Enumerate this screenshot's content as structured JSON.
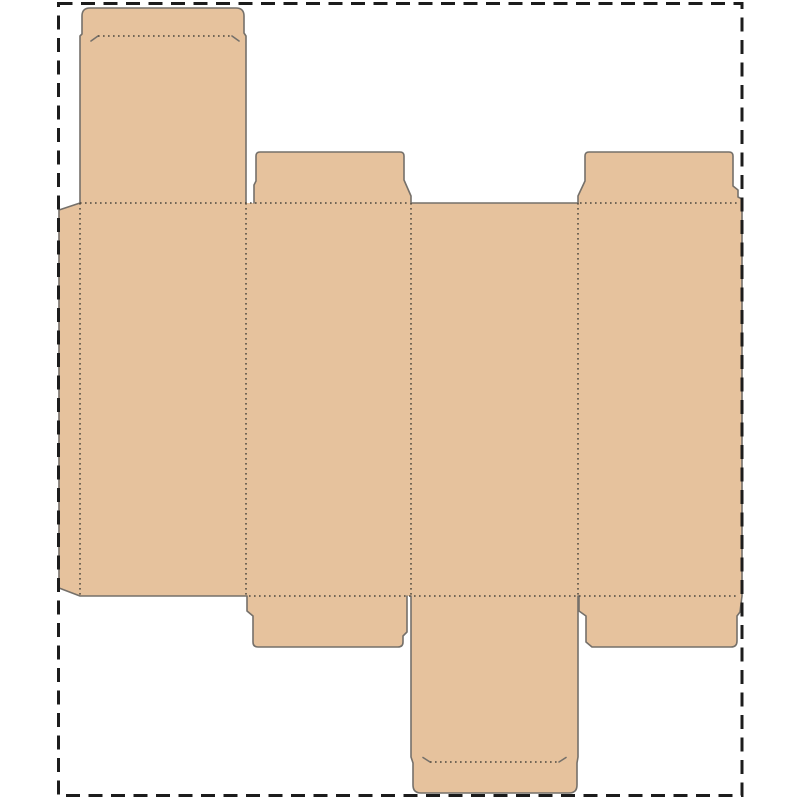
{
  "page": {
    "background_color": "#ffffff",
    "width_px": 800,
    "height_px": 800
  },
  "sheet_border": {
    "color": "#1c1c1c",
    "style": "dashed",
    "description": "outer rectangular dashed cut boundary of the sheet"
  },
  "dieline": {
    "type": "tuck-end folding carton box template (unfolded die-cut layout)",
    "material_color": "#e6c29d",
    "cut_line_color": "#75706a",
    "fold_line_color": "#4c473f",
    "fold_line_style": "dotted",
    "components": [
      "glue-flap-left",
      "side-panel-1",
      "side-panel-2",
      "side-panel-3",
      "side-panel-4",
      "tuck-lid-top-panel-1",
      "tuck-tab-top",
      "dust-flap-top-panel-2",
      "dust-flap-top-panel-4",
      "tuck-lid-bottom-panel-3",
      "tuck-tab-bottom",
      "dust-flap-bottom-panel-2",
      "dust-flap-bottom-panel-4"
    ]
  }
}
